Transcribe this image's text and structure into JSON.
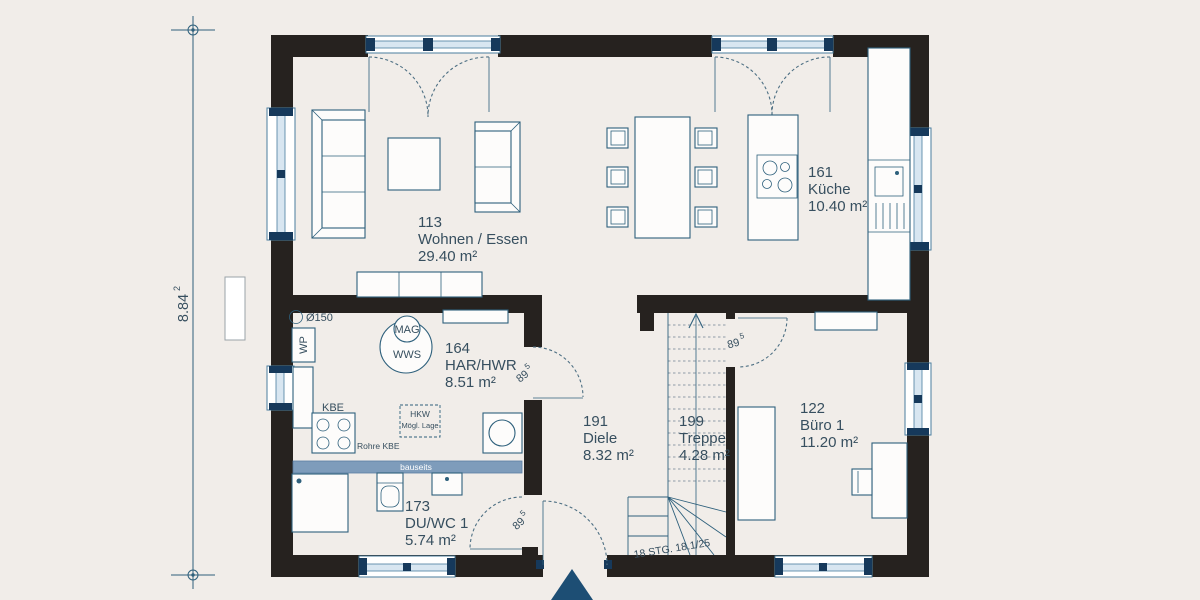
{
  "plan": {
    "dimension": {
      "value": "8.84",
      "sup": "2"
    },
    "door_width": {
      "value": "89",
      "sup": "5"
    },
    "rooms": [
      {
        "id": "113",
        "name": "Wohnen / Essen",
        "area": "29.40 m²"
      },
      {
        "id": "161",
        "name": "Küche",
        "area": "10.40 m²"
      },
      {
        "id": "164",
        "name": "HAR/HWR",
        "area": "8.51 m²"
      },
      {
        "id": "191",
        "name": "Diele",
        "area": "8.32 m²"
      },
      {
        "id": "199",
        "name": "Treppe",
        "area": "4.28 m²"
      },
      {
        "id": "122",
        "name": "Büro 1",
        "area": "11.20 m²"
      },
      {
        "id": "173",
        "name": "DU/WC 1",
        "area": "5.74 m²"
      }
    ],
    "annotations": {
      "diameter": "Ø150",
      "wp": "WP",
      "mag": "MAG",
      "wws": "WWS",
      "kbe": "KBE",
      "rohre_kbe": "Rohre KBE",
      "hkw_1": "HKW",
      "hkw_2": "Mögl. Lage",
      "bauseits": "bauseits",
      "stairs_note": "18 STG. 18.1/25"
    },
    "colors": {
      "wall": "#26221f",
      "floor": "#f1ede9",
      "line": "#2e607c",
      "arc": "#4d6f83",
      "tread": "#8e9ca8",
      "text": "#374f5f",
      "glass": "#d8e6f1",
      "wline": "#4a7d9e",
      "navy": "#16395b",
      "band": "#7e9cbb",
      "tri": "#1d4e74",
      "dimline": "#2e607c",
      "white": "#fdfcfb"
    }
  }
}
